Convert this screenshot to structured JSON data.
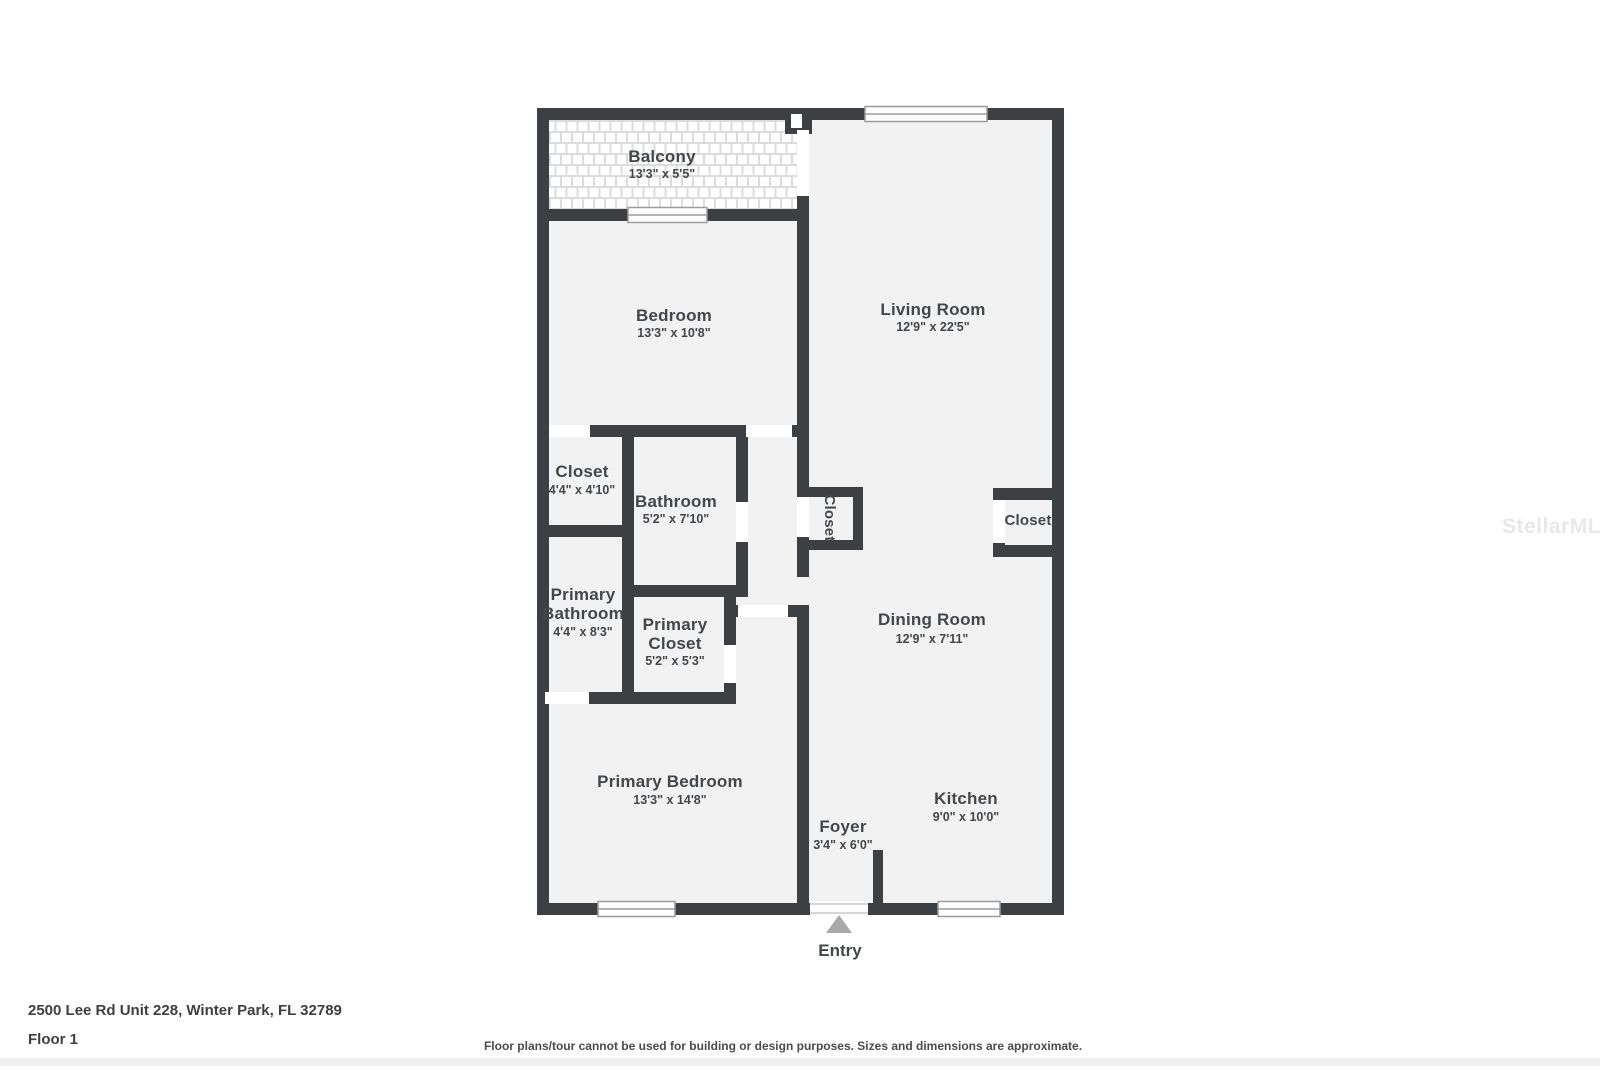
{
  "colors": {
    "wall": "#3d4043",
    "floor": "#f2f2f2",
    "balcony_tile": "#dcdcdc",
    "window_frame": "#9b9b9b",
    "entry_arrow": "#a9a9a9",
    "label_text": "#43474a"
  },
  "plan": {
    "rooms": {
      "balcony": {
        "name": "Balcony",
        "dims": "13'3\" x 5'5\""
      },
      "bedroom": {
        "name": "Bedroom",
        "dims": "13'3\" x 10'8\""
      },
      "living_room": {
        "name": "Living Room",
        "dims": "12'9\" x 22'5\""
      },
      "hall_closet": {
        "name": "Closet",
        "dims": "4'4\" x 4'10\""
      },
      "bathroom": {
        "name": "Bathroom",
        "dims": "5'2\" x 7'10\""
      },
      "middle_closet": {
        "name": "Closet"
      },
      "right_closet": {
        "name": "Closet"
      },
      "primary_bathroom": {
        "name_line1": "Primary",
        "name_line2": "Bathroom",
        "dims": "4'4\" x 8'3\""
      },
      "primary_closet": {
        "name_line1": "Primary",
        "name_line2": "Closet",
        "dims": "5'2\" x 5'3\""
      },
      "dining_room": {
        "name": "Dining Room",
        "dims": "12'9\" x 7'11\""
      },
      "primary_bedroom": {
        "name": "Primary Bedroom",
        "dims": "13'3\" x 14'8\""
      },
      "foyer": {
        "name": "Foyer",
        "dims": "3'4\" x 6'0\""
      },
      "kitchen": {
        "name": "Kitchen",
        "dims": "9'0\" x 10'0\""
      }
    },
    "entry_label": "Entry"
  },
  "watermark": "StellarMLS",
  "footer": {
    "address": "2500 Lee Rd Unit 228, Winter Park, FL 32789",
    "floor": "Floor 1",
    "disclaimer": "Floor plans/tour cannot be used for building or design purposes. Sizes and dimensions are approximate."
  }
}
